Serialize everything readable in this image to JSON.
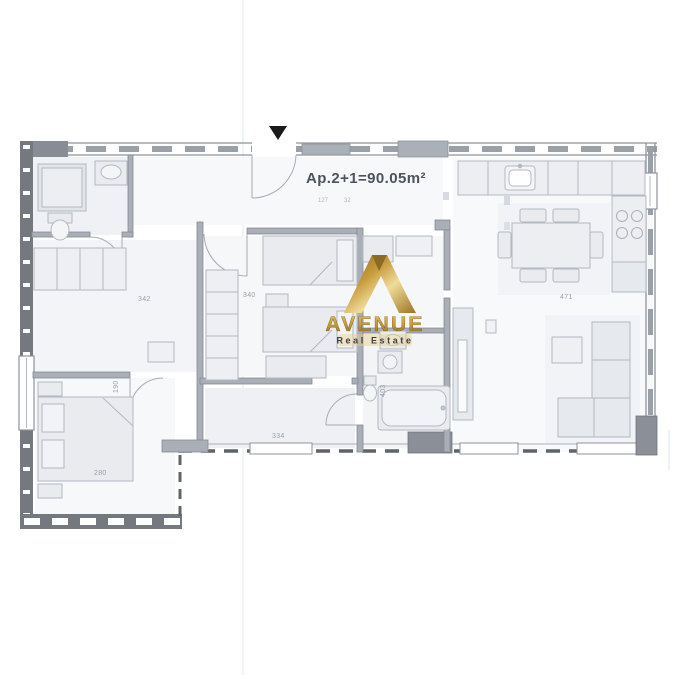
{
  "header": {
    "title": "Ap.2+1=90.05m²",
    "dim_left": "127",
    "dim_right": "32"
  },
  "logo": {
    "brand": "AVENUE",
    "tagline": "Real Estate",
    "gold_dark": "#8a6a25",
    "gold_mid": "#c79a3b",
    "gold_light": "#f0dc9a"
  },
  "rooms": {
    "hall": {
      "dim": "342"
    },
    "bedroom_middle": {
      "dim": "340"
    },
    "living": {
      "dim": "471"
    },
    "bedroom_left": {
      "dim": "280"
    },
    "bedroom_left_width": {
      "dim": "190"
    },
    "corridor": {
      "dim": "334"
    },
    "bathroom_width": {
      "dim": "403"
    }
  },
  "colors": {
    "wall": "#a9aeb7",
    "wall_dark": "#74787f",
    "furniture_fill": "#e9ebee",
    "furniture_stroke": "#b3b9c2",
    "label": "#9aa0a8",
    "marker": "#1a1a1a"
  }
}
